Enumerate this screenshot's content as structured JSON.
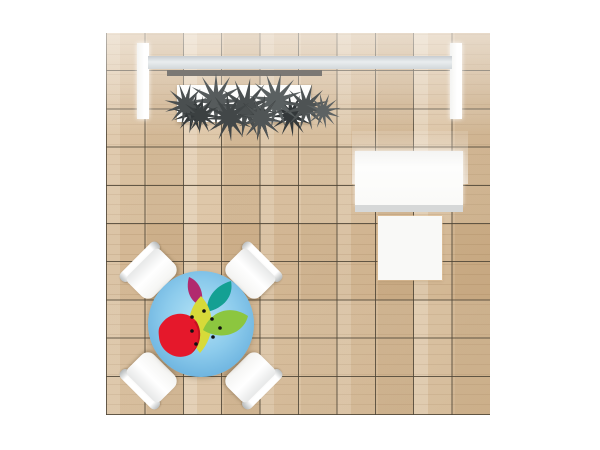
{
  "scene": {
    "name": "exhibit-booth-plan-view",
    "background_color": "#ffffff"
  },
  "floor": {
    "label": "wood tile flooring",
    "tile_columns": 10,
    "tile_rows": 10,
    "colors": {
      "wood_base": "#d7bd9c",
      "wood_light": "#e3cfae",
      "wood_dark": "#cfb28d",
      "grid_line": "#4e4536"
    }
  },
  "back_wall": {
    "label": "back wall with header beam and planter",
    "colors": {
      "end_panels": "#ffffff",
      "header_beam": "#e9edef",
      "beam_shadow_bar": "#7b7874",
      "planter_tray": "#fdfdfc",
      "foliage": "#53585a"
    }
  },
  "counter_area": {
    "label": "white counter with square table",
    "colors": {
      "counter_top": "#fdfdfc",
      "counter_front_edge": "#d6d8d8",
      "square_table_top": "#f9f9f7",
      "glow": "#ffffff"
    }
  },
  "meeting_area": {
    "label": "round logo table with four chairs",
    "chair_color": "#ffffff",
    "table_colors": {
      "center": "#b4e3f6",
      "mid": "#8ccbec",
      "edge": "#61a9d6"
    },
    "logo": {
      "label": "fruit and leaves logo",
      "colors": {
        "red_fruit": "#e5182b",
        "red_fruit_shade": "#c31220",
        "magenta_leaf": "#b12a6e",
        "teal_leaf": "#14a093",
        "yellow_green_leaf": "#d7da39",
        "green_leaf": "#8cc63f",
        "seeds": "#111111"
      }
    }
  }
}
